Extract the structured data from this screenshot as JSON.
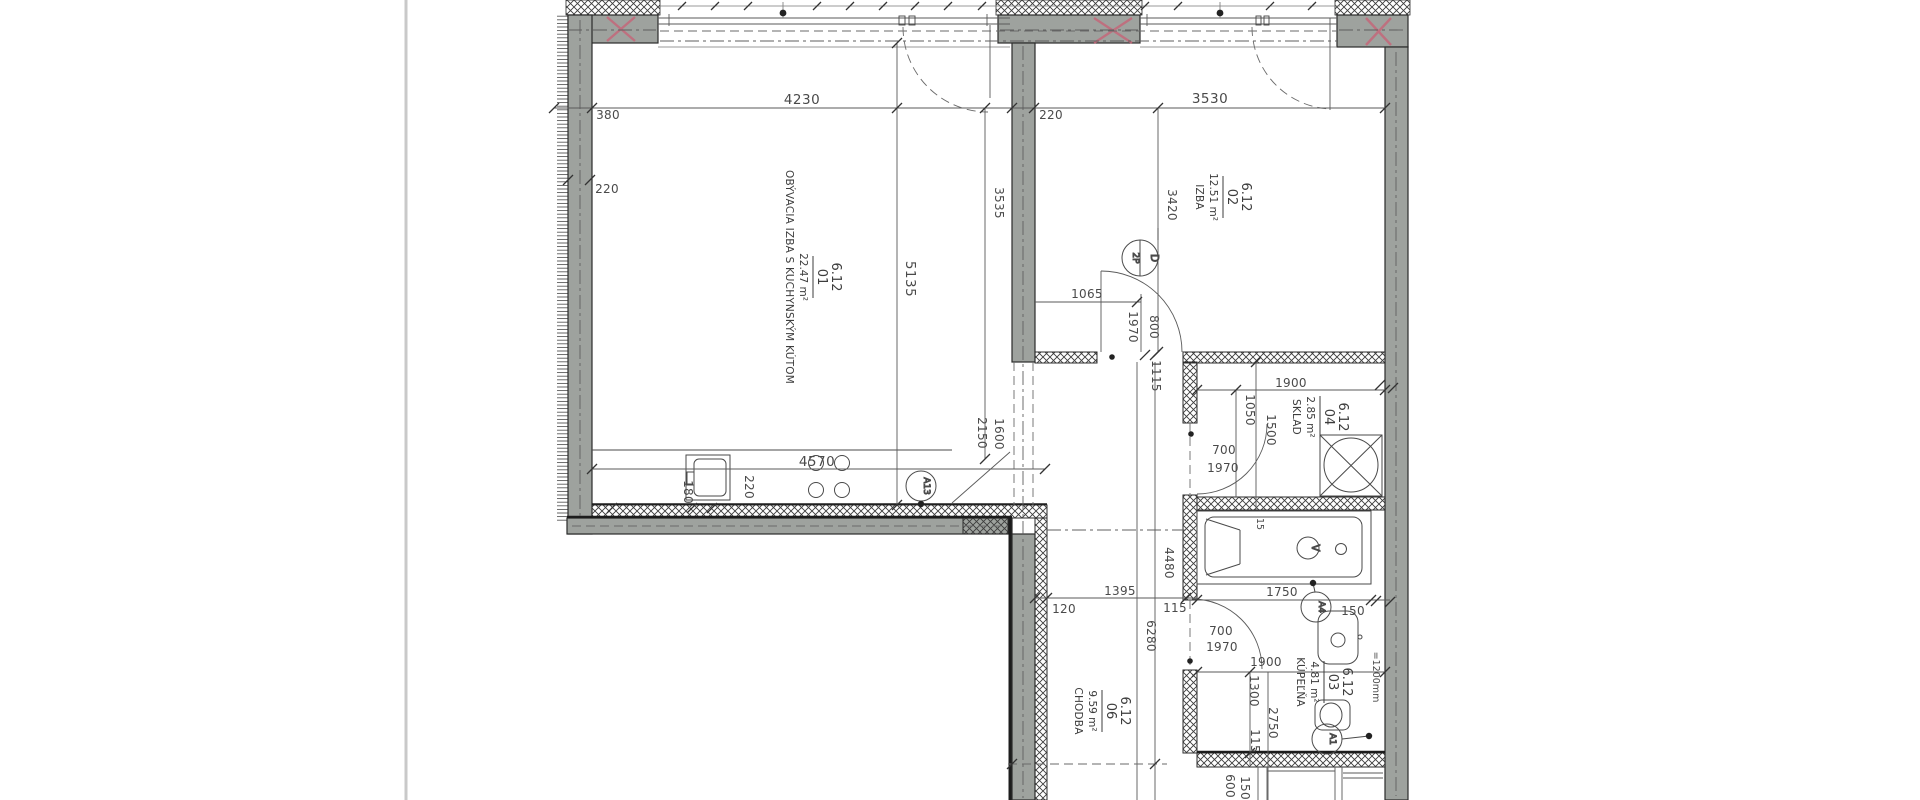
{
  "drawing": {
    "type": "apartment floor plan",
    "unit": "mm",
    "rooms": [
      {
        "code": "6.12",
        "num": "01",
        "area": "22.47 m²",
        "name": "OBÝVACIA IZBA S KUCHYNSKÝM KÚTOM"
      },
      {
        "code": "6.12",
        "num": "02",
        "area": "12.51 m²",
        "name": "IZBA"
      },
      {
        "code": "6.12",
        "num": "04",
        "area": "2.85 m²",
        "name": "SKLAD"
      },
      {
        "code": "6.12",
        "num": "03",
        "area": "4.81 m²",
        "name": "KÚPEĽŇA"
      },
      {
        "code": "6.12",
        "num": "06",
        "area": "9.59 m²",
        "name": "CHODBA"
      }
    ],
    "dims": {
      "d4230": "4230",
      "d3530": "3530",
      "d380": "380",
      "d220_left": "220",
      "d5135": "5135",
      "d3535": "3535",
      "d220_top": "220",
      "d3420": "3420",
      "d1065": "1065",
      "d1970_izba": "1970",
      "d800_izba": "800",
      "d1115": "1115",
      "d4570": "4570",
      "d180": "180",
      "d220_kitchen": "220",
      "d1600": "1600",
      "d2150": "2150",
      "d1900_sklad": "1900",
      "d1050": "1050",
      "d1500": "1500",
      "d700_sklad": "700",
      "d1970_sklad": "1970",
      "d4480": "4480",
      "d6280": "6280",
      "d120": "120",
      "d1395": "1395",
      "d115_wall": "115",
      "d1750": "1750",
      "d150_tub": "150",
      "d1900_bath": "1900",
      "d700_bath": "700",
      "d1970_bath": "1970",
      "d1300": "1300",
      "d2750": "2750",
      "d115_bath": "115",
      "d1200": "=1200mm",
      "d600": "600",
      "d150_bot": "150",
      "d15": "15"
    },
    "markers": {
      "a13": "A13",
      "a4": "A4",
      "a1": "A1",
      "v": "V",
      "d": "D",
      "p2": "2P"
    }
  }
}
